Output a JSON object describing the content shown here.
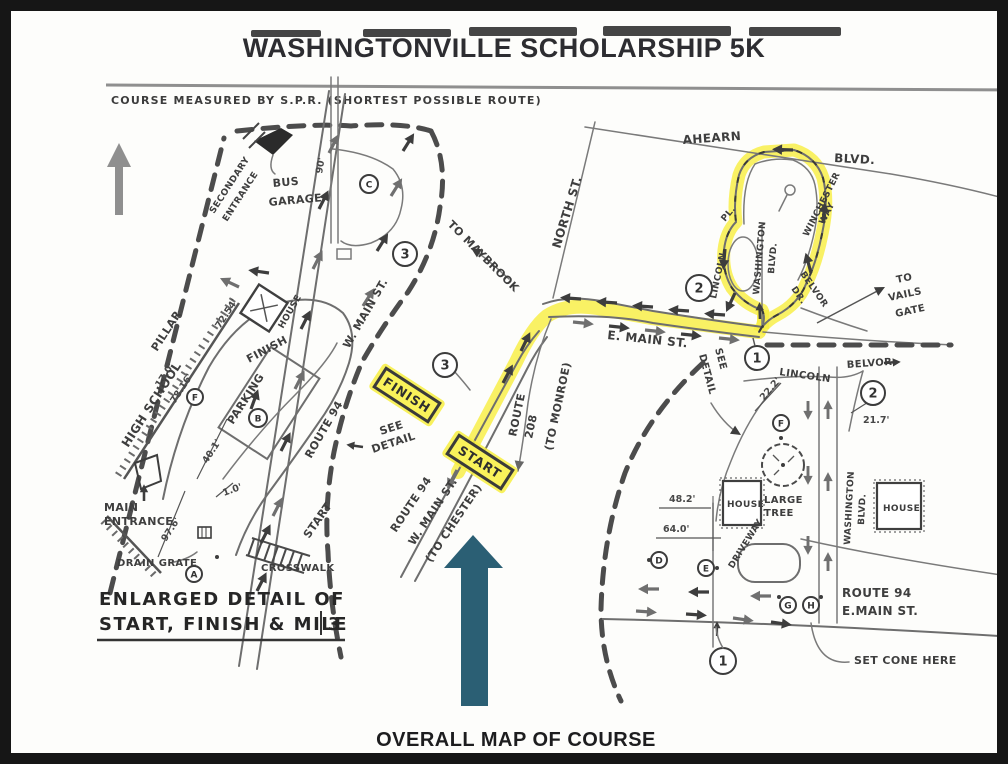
{
  "header": {
    "title": "WASHINGTONVILLE SCHOLARSHIP 5K",
    "course_note": "COURSE MEASURED BY S.P.R. (SHORTEST POSSIBLE ROUTE)"
  },
  "captions": {
    "detail_line1": "ENLARGED DETAIL OF",
    "detail_line2": "START, FINISH & MILE",
    "detail_mile_number": "3",
    "overall": "OVERALL MAP OF COURSE"
  },
  "colors": {
    "route_highlight": "#f7ee3f",
    "overall_arrow": "#2b5f74",
    "ink": "#4a4a4a"
  },
  "map_labels": {
    "high_school": "HIGH SCHOOL",
    "pillar": "PILLAR",
    "secondary_entrance": [
      "SECONDARY",
      "ENTRANCE"
    ],
    "bus_garage": [
      "BUS",
      "GARAGE"
    ],
    "main_entrance": [
      "MAIN",
      "ENTRANCE"
    ],
    "drain_grate": "DRAIN GRATE",
    "crosswalk": "CROSSWALK",
    "start_road": "START",
    "parking": "PARKING",
    "finish_area": "FINISH",
    "house": "HOUSE",
    "route94_detail": [
      "ROUTE 94",
      "W. MAIN ST."
    ],
    "north_st": "NORTH ST.",
    "to_maybrook": "TO MAYBROOK",
    "e_main_st": "E. MAIN ST.",
    "route_208": [
      "ROUTE",
      "208",
      "(TO MONROE)"
    ],
    "route94_center": [
      "ROUTE 94",
      "W. MAIN ST.",
      "(TO CHESTER)"
    ],
    "see_detail": [
      "SEE",
      "DETAIL"
    ],
    "start_box": "START",
    "finish_box": "FINISH",
    "ahearn": "AHEARN",
    "ahearn_blvd": "BLVD.",
    "winchester_way": [
      "WINCHESTER",
      "WAY"
    ],
    "lincoln_pl": [
      "LINCOLN",
      "PL."
    ],
    "washington_blvd": [
      "WASHINGTON",
      "BLVD."
    ],
    "belvor_dr": [
      "BELVOR",
      "DR."
    ],
    "to_vails_gate": [
      "TO",
      "VAILS",
      "GATE"
    ],
    "lincoln_detail": "LINCOLN",
    "belvor_detail": "BELVOR",
    "large_tree": [
      "LARGE",
      "TREE"
    ],
    "driveway": "DRIVEWAY",
    "route94_emain": [
      "ROUTE 94",
      "E.MAIN ST."
    ],
    "set_cone": "SET CONE HERE"
  },
  "measurements": {
    "m17_0": "17.0'",
    "m78_16": "78.16'",
    "m72_54": "72.54'",
    "m40_1": "40.1'",
    "m1_0": "1.0'",
    "m97_6": "97.6'",
    "m90": "90'",
    "m22_2": "22.2'",
    "m21_7": "21.7'",
    "m48_2": "48.2'",
    "m64_0": "64.0'"
  },
  "markers": {
    "n1": "1",
    "n2": "2",
    "n3": "3",
    "a": "A",
    "b": "B",
    "c": "C",
    "d": "D",
    "e": "E",
    "f": "F",
    "g": "G",
    "h": "H"
  }
}
